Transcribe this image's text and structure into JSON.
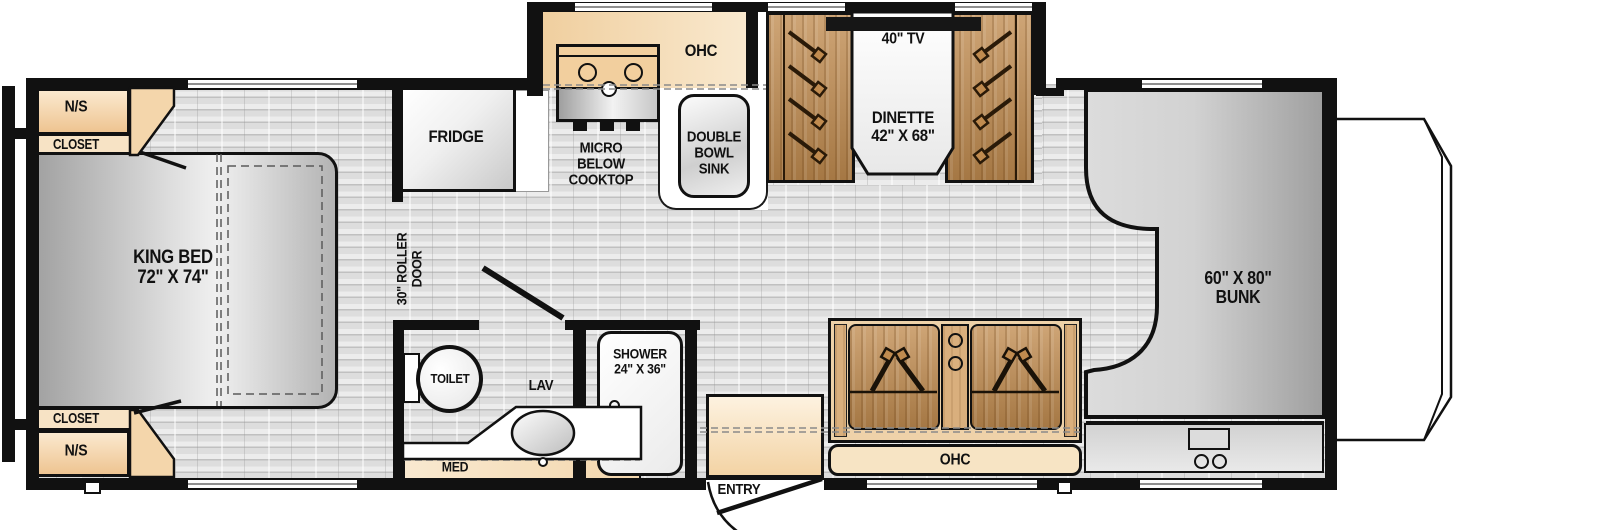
{
  "diagram": {
    "bedroom": {
      "ns_top": "N/S",
      "closet_top": "CLOSET",
      "king_bed_line1": "KING BED",
      "king_bed_line2": "72\" X 74\"",
      "closet_bottom": "CLOSET",
      "ns_bottom": "N/S",
      "roller_door_line1": "30\" ROLLER",
      "roller_door_line2": "DOOR"
    },
    "kitchen": {
      "fridge": "FRIDGE",
      "ohc": "OHC",
      "micro_line1": "MICRO",
      "micro_line2": "BELOW",
      "micro_line3": "COOKTOP",
      "sink_line1": "DOUBLE",
      "sink_line2": "BOWL",
      "sink_line3": "SINK"
    },
    "dinette": {
      "tv": "40\" TV",
      "name": "DINETTE",
      "size": "42\" X 68\""
    },
    "bathroom": {
      "toilet": "TOILET",
      "lav": "LAV",
      "shower": "SHOWER",
      "shower_size": "24\" X 36\"",
      "med": "MED"
    },
    "living": {
      "entry": "ENTRY",
      "ohc": "OHC"
    },
    "cabover": {
      "bunk_size": "60\" X 80\"",
      "bunk": "BUNK"
    }
  },
  "colors": {
    "wall": "#111111",
    "floor": "#e4e4e4",
    "cabinet_tan": "#f4d9b2",
    "bench_wood": "#c08b4f",
    "counter_white": "#ffffff",
    "appliance_gray": "#d9d9d9",
    "tv_black": "#161616"
  }
}
